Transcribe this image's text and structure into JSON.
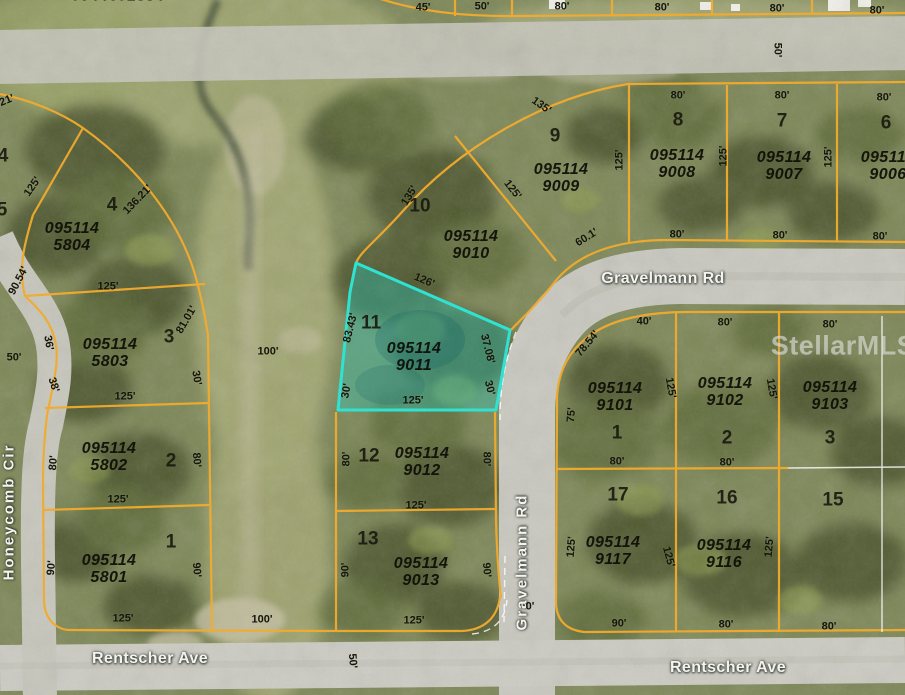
{
  "watermark": "StellarMLS",
  "highlight": {
    "apn": "095114 9011",
    "lot": "11",
    "border_color": "#30e2d2",
    "fill_color": "rgba(38,205,195,0.36)"
  },
  "colors": {
    "parcel_line": "#f2ab2e",
    "road": "#c9c8bf",
    "highlight": "#30e2d2"
  },
  "streets": [
    {
      "label": "Gravelmann Rd",
      "x": 663,
      "y": 279,
      "rot": 0
    },
    {
      "label": "Gravelmann Rd",
      "x": 522,
      "y": 562,
      "rot": -90
    },
    {
      "label": "Rentscher Ave",
      "x": 150,
      "y": 659,
      "rot": 0
    },
    {
      "label": "Rentscher Ave",
      "x": 728,
      "y": 668,
      "rot": 0
    },
    {
      "label": "Honeycomb Cir",
      "x": 9,
      "y": 512,
      "rot": -90
    }
  ],
  "parcels": [
    {
      "apn": "095114 9009",
      "x": 561,
      "y": 178
    },
    {
      "apn": "095114 9008",
      "x": 677,
      "y": 164
    },
    {
      "apn": "095114 9007",
      "x": 784,
      "y": 166
    },
    {
      "apn": "095114 9006",
      "x": 888,
      "y": 166
    },
    {
      "apn": "095114 9010",
      "x": 471,
      "y": 245
    },
    {
      "apn": "095114 9011",
      "x": 414,
      "y": 357
    },
    {
      "apn": "095114 9012",
      "x": 422,
      "y": 462
    },
    {
      "apn": "095114 9013",
      "x": 421,
      "y": 572
    },
    {
      "apn": "095114 9101",
      "x": 615,
      "y": 397
    },
    {
      "apn": "095114 9102",
      "x": 725,
      "y": 392
    },
    {
      "apn": "095114 9103",
      "x": 830,
      "y": 396
    },
    {
      "apn": "095114 9117",
      "x": 613,
      "y": 551
    },
    {
      "apn": "095114 9116",
      "x": 724,
      "y": 554
    },
    {
      "apn": "095114 5804",
      "x": 72,
      "y": 237
    },
    {
      "apn": "095114 5803",
      "x": 110,
      "y": 353
    },
    {
      "apn": "095114 5802",
      "x": 109,
      "y": 457
    },
    {
      "apn": "095114 5801",
      "x": 109,
      "y": 569
    }
  ],
  "lots": [
    {
      "label": "9",
      "x": 555,
      "y": 136
    },
    {
      "label": "8",
      "x": 678,
      "y": 120
    },
    {
      "label": "7",
      "x": 782,
      "y": 121
    },
    {
      "label": "6",
      "x": 886,
      "y": 123
    },
    {
      "label": "10",
      "x": 420,
      "y": 206
    },
    {
      "label": "11",
      "x": 371,
      "y": 323
    },
    {
      "label": "12",
      "x": 369,
      "y": 456
    },
    {
      "label": "13",
      "x": 368,
      "y": 539
    },
    {
      "label": "1",
      "x": 617,
      "y": 433
    },
    {
      "label": "2",
      "x": 727,
      "y": 438
    },
    {
      "label": "3",
      "x": 830,
      "y": 438
    },
    {
      "label": "17",
      "x": 618,
      "y": 495
    },
    {
      "label": "16",
      "x": 727,
      "y": 498
    },
    {
      "label": "15",
      "x": 833,
      "y": 500
    },
    {
      "label": "4",
      "x": 112,
      "y": 205
    },
    {
      "label": "3",
      "x": 169,
      "y": 337
    },
    {
      "label": "2",
      "x": 171,
      "y": 461
    },
    {
      "label": "1",
      "x": 171,
      "y": 542
    }
  ],
  "dims": [
    {
      "label": "45'",
      "x": 423,
      "y": 8,
      "rot": 0
    },
    {
      "label": "50'",
      "x": 482,
      "y": 7,
      "rot": 0
    },
    {
      "label": "80'",
      "x": 562,
      "y": 7,
      "rot": 0
    },
    {
      "label": "80'",
      "x": 662,
      "y": 8,
      "rot": 0
    },
    {
      "label": "80'",
      "x": 777,
      "y": 9,
      "rot": 0
    },
    {
      "label": "80'",
      "x": 877,
      "y": 11,
      "rot": 0
    },
    {
      "label": "50'",
      "x": 777,
      "y": 50,
      "rot": 90
    },
    {
      "label": "135'",
      "x": 541,
      "y": 106,
      "rot": 35
    },
    {
      "label": "80'",
      "x": 678,
      "y": 96,
      "rot": 0
    },
    {
      "label": "80'",
      "x": 782,
      "y": 96,
      "rot": 0
    },
    {
      "label": "80'",
      "x": 884,
      "y": 98,
      "rot": 0
    },
    {
      "label": "125'",
      "x": 620,
      "y": 160,
      "rot": -90
    },
    {
      "label": "125'",
      "x": 724,
      "y": 156,
      "rot": -90
    },
    {
      "label": "125'",
      "x": 829,
      "y": 157,
      "rot": -90
    },
    {
      "label": "125'",
      "x": 512,
      "y": 190,
      "rot": 52
    },
    {
      "label": "80'",
      "x": 677,
      "y": 235,
      "rot": 0
    },
    {
      "label": "80'",
      "x": 780,
      "y": 236,
      "rot": 0
    },
    {
      "label": "80'",
      "x": 880,
      "y": 237,
      "rot": 0
    },
    {
      "label": "60.1'",
      "x": 587,
      "y": 238,
      "rot": -32
    },
    {
      "label": "135'",
      "x": 410,
      "y": 196,
      "rot": -58
    },
    {
      "label": "126'",
      "x": 424,
      "y": 281,
      "rot": 23
    },
    {
      "label": "83.43'",
      "x": 351,
      "y": 328,
      "rot": -76
    },
    {
      "label": "30'",
      "x": 347,
      "y": 391,
      "rot": -80
    },
    {
      "label": "125'",
      "x": 413,
      "y": 401,
      "rot": 0
    },
    {
      "label": "37.08'",
      "x": 487,
      "y": 349,
      "rot": 76
    },
    {
      "label": "30'",
      "x": 489,
      "y": 388,
      "rot": 76
    },
    {
      "label": "80'",
      "x": 347,
      "y": 459,
      "rot": -90
    },
    {
      "label": "80'",
      "x": 486,
      "y": 459,
      "rot": 90
    },
    {
      "label": "125'",
      "x": 416,
      "y": 506,
      "rot": 0
    },
    {
      "label": "90'",
      "x": 346,
      "y": 570,
      "rot": -90
    },
    {
      "label": "90'",
      "x": 486,
      "y": 570,
      "rot": 85
    },
    {
      "label": "125'",
      "x": 414,
      "y": 621,
      "rot": 0
    },
    {
      "label": "100'",
      "x": 262,
      "y": 620,
      "rot": 0
    },
    {
      "label": "50'",
      "x": 352,
      "y": 661,
      "rot": 85
    },
    {
      "label": "0'",
      "x": 530,
      "y": 607,
      "rot": 0
    },
    {
      "label": "100'",
      "x": 268,
      "y": 352,
      "rot": 0
    },
    {
      "label": "21'",
      "x": 7,
      "y": 101,
      "rot": -22
    },
    {
      "label": "125'",
      "x": 33,
      "y": 187,
      "rot": -55
    },
    {
      "label": "136.21'",
      "x": 138,
      "y": 200,
      "rot": -46
    },
    {
      "label": "90.54'",
      "x": 19,
      "y": 281,
      "rot": -62
    },
    {
      "label": "50'",
      "x": 14,
      "y": 358,
      "rot": 0
    },
    {
      "label": "36'",
      "x": 48,
      "y": 343,
      "rot": 80
    },
    {
      "label": "38'",
      "x": 53,
      "y": 385,
      "rot": 72
    },
    {
      "label": "81.01'",
      "x": 187,
      "y": 320,
      "rot": -60
    },
    {
      "label": "30'",
      "x": 196,
      "y": 378,
      "rot": 80
    },
    {
      "label": "125'",
      "x": 125,
      "y": 397,
      "rot": 0
    },
    {
      "label": "125'",
      "x": 108,
      "y": 287,
      "rot": 0
    },
    {
      "label": "80'",
      "x": 54,
      "y": 463,
      "rot": -85
    },
    {
      "label": "80'",
      "x": 196,
      "y": 460,
      "rot": 85
    },
    {
      "label": "125'",
      "x": 118,
      "y": 500,
      "rot": 0
    },
    {
      "label": "90'",
      "x": 52,
      "y": 568,
      "rot": -85
    },
    {
      "label": "90'",
      "x": 196,
      "y": 570,
      "rot": 85
    },
    {
      "label": "125'",
      "x": 123,
      "y": 619,
      "rot": 0
    },
    {
      "label": "78.54'",
      "x": 588,
      "y": 344,
      "rot": -50
    },
    {
      "label": "40'",
      "x": 644,
      "y": 322,
      "rot": 0
    },
    {
      "label": "80'",
      "x": 725,
      "y": 323,
      "rot": 0
    },
    {
      "label": "80'",
      "x": 830,
      "y": 325,
      "rot": 0
    },
    {
      "label": "75'",
      "x": 572,
      "y": 415,
      "rot": -85
    },
    {
      "label": "125'",
      "x": 670,
      "y": 388,
      "rot": 80
    },
    {
      "label": "125'",
      "x": 771,
      "y": 389,
      "rot": 80
    },
    {
      "label": "80'",
      "x": 617,
      "y": 462,
      "rot": 0
    },
    {
      "label": "80'",
      "x": 727,
      "y": 463,
      "rot": 0
    },
    {
      "label": "125'",
      "x": 572,
      "y": 547,
      "rot": -85
    },
    {
      "label": "125'",
      "x": 668,
      "y": 557,
      "rot": 75
    },
    {
      "label": "125'",
      "x": 770,
      "y": 547,
      "rot": -85
    },
    {
      "label": "90'",
      "x": 619,
      "y": 624,
      "rot": 0
    },
    {
      "label": "80'",
      "x": 726,
      "y": 625,
      "rot": 0
    },
    {
      "label": "80'",
      "x": 829,
      "y": 627,
      "rot": 0
    }
  ],
  "partials": [
    {
      "label": "0944601884",
      "x": 118,
      "y": -4,
      "kind": "apn",
      "rot": 0
    },
    {
      "label": "4",
      "x": 3,
      "y": 156,
      "kind": "lot",
      "rot": 0
    },
    {
      "label": "5",
      "x": 2,
      "y": 210,
      "kind": "lot",
      "rot": 0
    }
  ]
}
